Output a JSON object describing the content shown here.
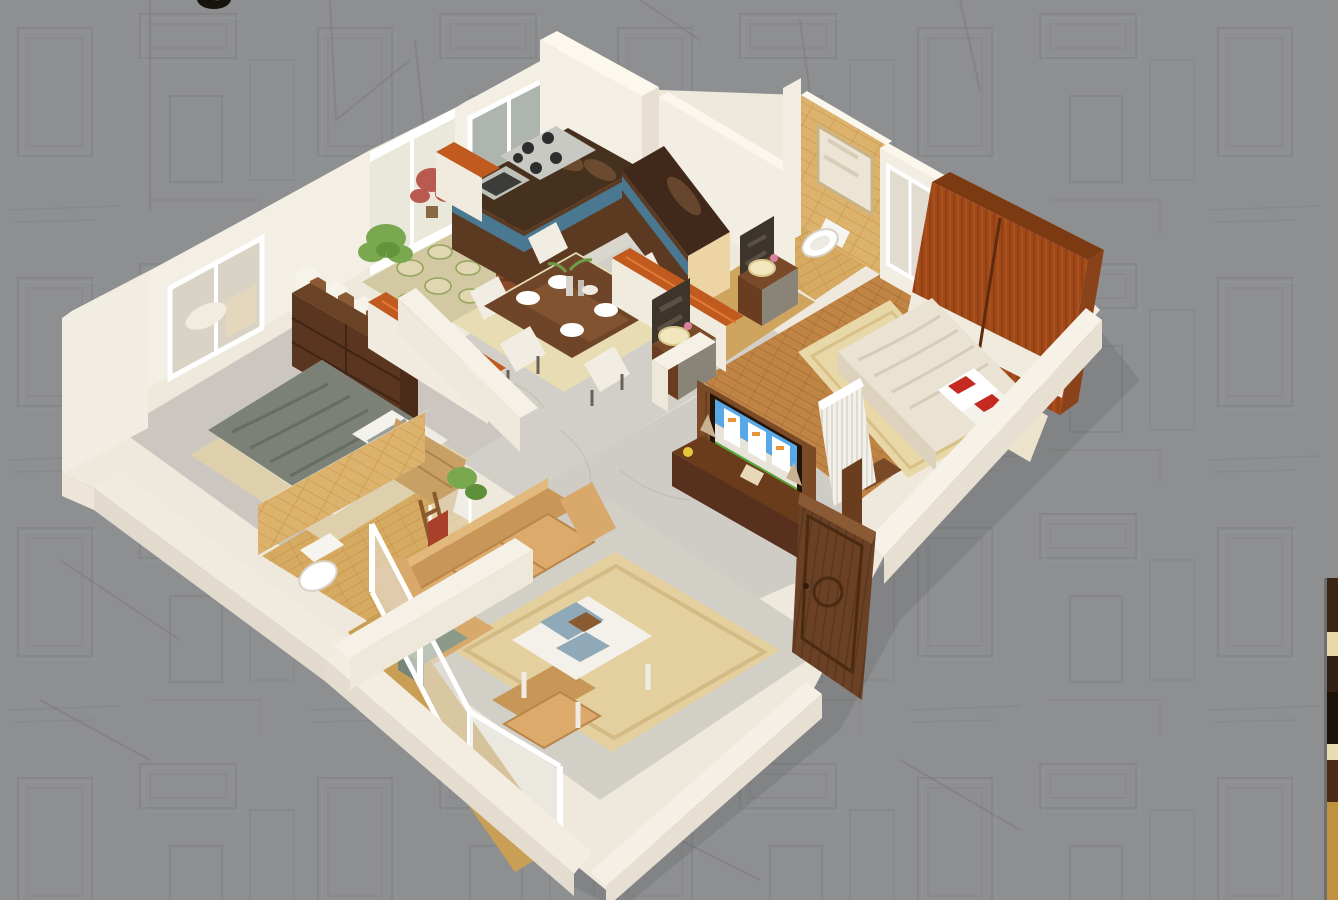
{
  "meta": {
    "kind": "3d-isometric-floor-plan-render",
    "description": "Photorealistic 3D cutaway floor plan of a 2BHK apartment on a gray architectural-sketch background; a sliver of the next render peeks at the right edge and a cropped dark letter glyph shows at the top edge."
  },
  "palette": {
    "bg_gray": "#8e8f90",
    "sketch_line": "#7b7c7e",
    "wall_face": "#f3eee4",
    "wall_top": "#fbf7ee",
    "wall_shadow": "#e4ddd0",
    "floor_marble": "#d3d0c9",
    "floor_marble_light": "#d9d6ce",
    "floor_wood": "#c08445",
    "floor_tile_tan": "#d7aa61",
    "rug_beige": "#e6d3a0",
    "counter_dark": "#46311f",
    "counter_teal": "#4a7890",
    "cabinet_brown": "#6e4526",
    "cabinet_cream": "#ecd4a4",
    "wardrobe_wood": "#a04818",
    "accent_orange": "#c05a1e",
    "sofa_tan": "#d9a96c",
    "blanket_olive": "#7b8177",
    "door_wood": "#6a4124",
    "red_accent": "#c42a20",
    "plant_green": "#7aa84e",
    "tv_sky": "#58a8e8",
    "tv_grass": "#57a83a",
    "basin_cream": "#f1e6bc",
    "glyph_black": "#17130f",
    "strip_dark_wood": "#3c2514",
    "strip_cream": "#ead9a8",
    "strip_tan": "#c2913f"
  },
  "scene": {
    "rooms": [
      {
        "name": "kitchen",
        "features": [
          "l-shaped-counter",
          "dark-granite-top",
          "teal-stripe-cabinets",
          "gas-hob",
          "sink",
          "window",
          "red-swastika-decor"
        ]
      },
      {
        "name": "utility-courtyard",
        "features": [
          "stone-floor",
          "green-fern-plant",
          "red-plant",
          "glass-sliding-partition"
        ]
      },
      {
        "name": "dining-area",
        "features": [
          "wooden-table",
          "white-upholstered-chairs",
          "tableware",
          "beige-rug",
          "orange-capped-half-walls"
        ]
      },
      {
        "name": "wash-area",
        "features": [
          "two-vanity-basins",
          "mirrors"
        ]
      },
      {
        "name": "bathroom-1",
        "features": [
          "tan-brick-tile-wall",
          "wall-hung-toilet",
          "mirror",
          "wood-look-floor"
        ]
      },
      {
        "name": "master-bedroom",
        "features": [
          "wood-plank-floor",
          "mahogany-wardrobe-with-white-band",
          "double-bed-cream-duvet",
          "white-pillows-red-accents",
          "headboard",
          "white-slat-radiator",
          "window"
        ]
      },
      {
        "name": "foyer",
        "features": [
          "marble-floor",
          "tv-panel-showing-building-render",
          "wood-media-shelf",
          "open-carved-entry-door"
        ]
      },
      {
        "name": "bedroom-2",
        "features": [
          "olive-gray-blanket-bed",
          "tan-headboard",
          "dark-dresser-with-white-organizers",
          "window",
          "rug",
          "corner-plant"
        ]
      },
      {
        "name": "bathroom-2",
        "features": [
          "tan-tile-walls",
          "toilet",
          "glass-shower",
          "plant",
          "towel-ladder"
        ]
      },
      {
        "name": "living-room",
        "features": [
          "tan-sofa-set",
          "white-coffee-table-with-blue-trays",
          "large-beige-rug",
          "balcony-glazing",
          "teal-side-box",
          "low-parapet-walls"
        ]
      }
    ],
    "edge_elements": [
      {
        "name": "cropped-letter-glyph",
        "position": "top-left-edge"
      },
      {
        "name": "next-image-sliver",
        "position": "right-edge",
        "content": "wood-and-cream bands of adjacent render"
      }
    ]
  }
}
